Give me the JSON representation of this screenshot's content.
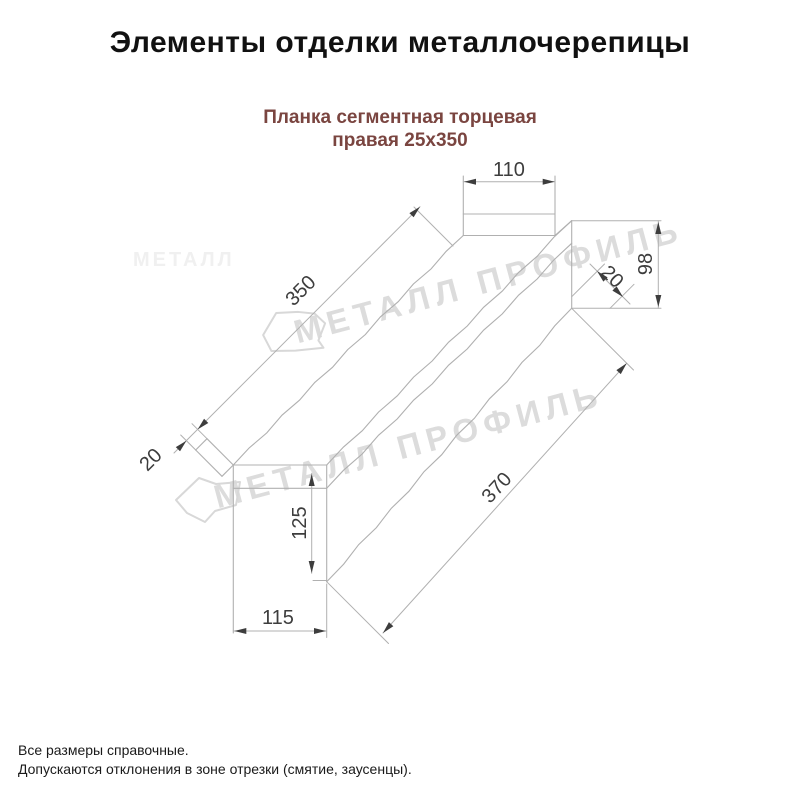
{
  "title": "Элементы отделки металлочерепицы",
  "subtitle_line1": "Планка сегментная торцевая",
  "subtitle_line2": "правая 25х350",
  "watermark": {
    "text": "МЕТАЛЛ ПРОФИЛЬ",
    "faint_fragment": "МЕТАЛЛ"
  },
  "dimensions": {
    "tab_width": "110",
    "end_height": "98",
    "end_fold": "20",
    "length_top": "350",
    "tip_fold": "20",
    "bottom_height": "125",
    "bottom_width": "115",
    "length_bottom": "370"
  },
  "footnotes": {
    "line1": "Все размеры справочные.",
    "line2": "Допускаются отклонения в зоне отрезки (смятие, заусенцы)."
  },
  "colors": {
    "line": "#b0b0b0",
    "dim_text": "#3d3d3d",
    "subtitle_accent": "#7a4540",
    "watermark": "#dcdcdc"
  }
}
